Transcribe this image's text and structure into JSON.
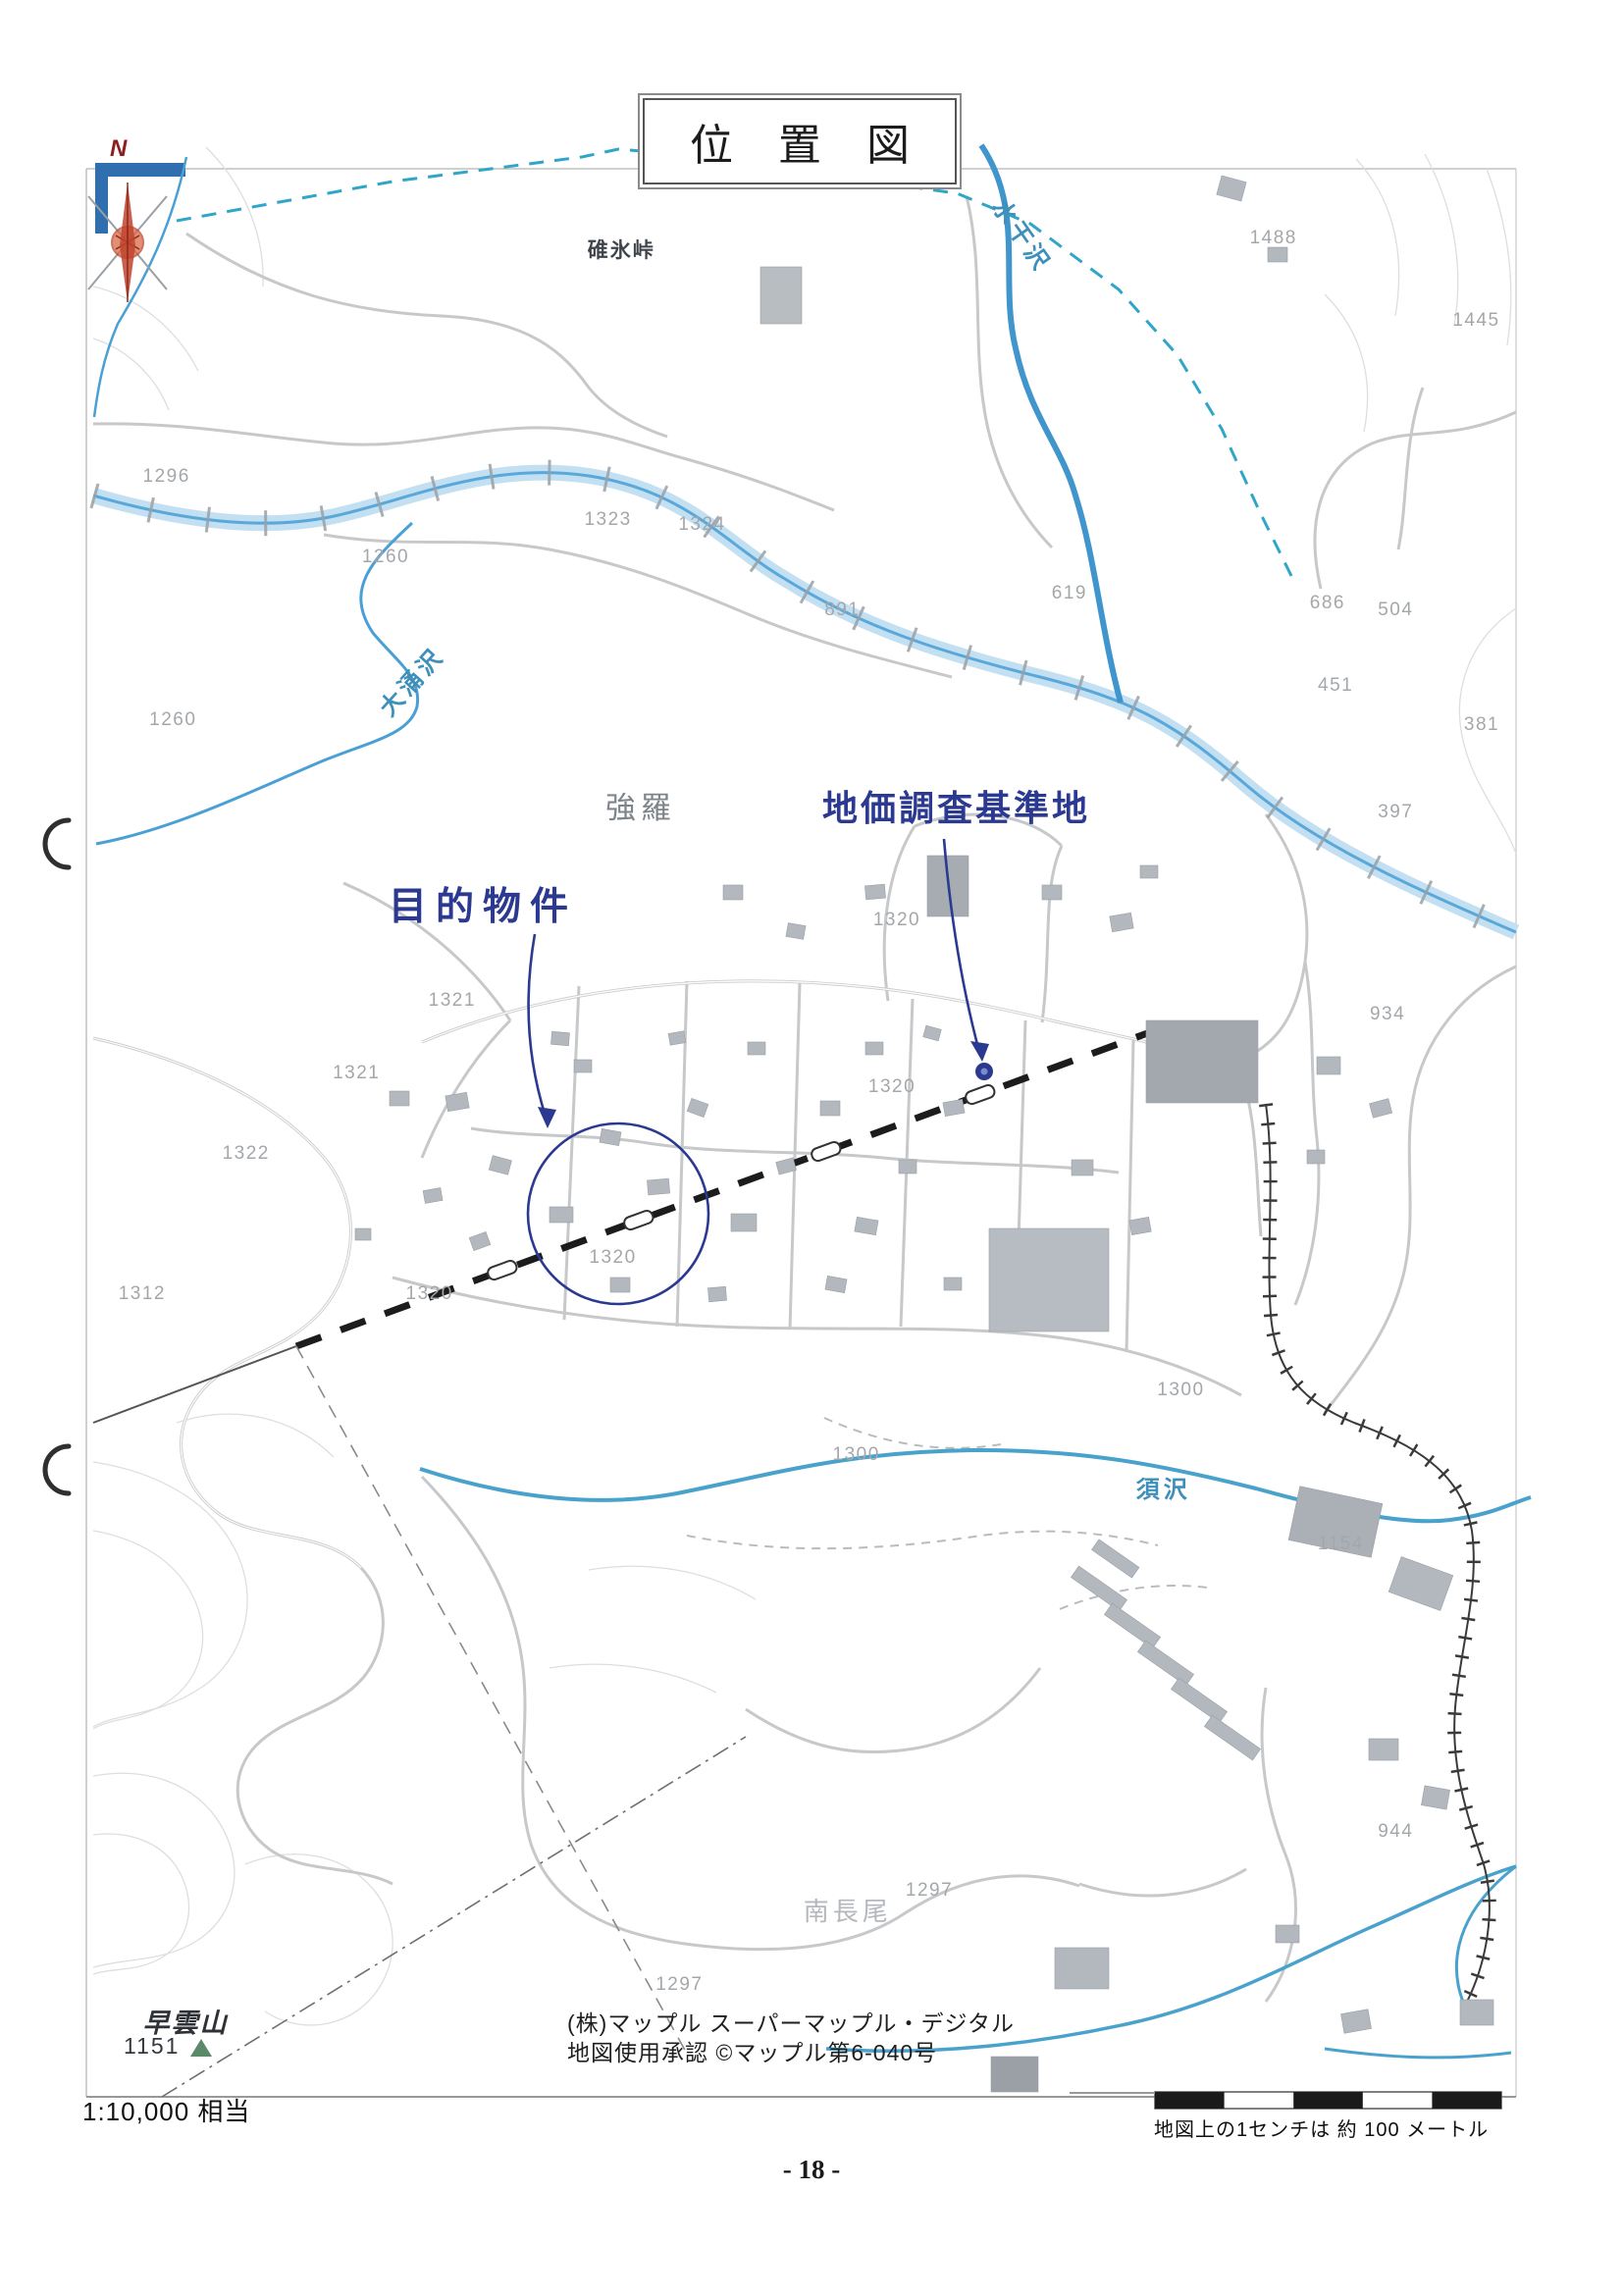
{
  "title": "位置図",
  "compass": {
    "n": "N"
  },
  "annotations": {
    "target_property": "目的物件",
    "survey_point": "地価調査基準地"
  },
  "map": {
    "place_labels": [
      {
        "text": "碓氷峠",
        "x": 36.2,
        "y": 10.2,
        "cls": "lbl-pass"
      },
      {
        "text": "強羅",
        "x": 37.3,
        "y": 34.1,
        "cls": "lbl-town"
      },
      {
        "text": "南長尾",
        "x": 49.5,
        "y": 82.4,
        "cls": "lbl-area"
      },
      {
        "text": "大涌沢",
        "x": 23.6,
        "y": 30.2,
        "cls": "lbl-river",
        "rotate": -48
      },
      {
        "text": "水干沢",
        "x": 61.6,
        "y": 8.0,
        "cls": "lbl-river",
        "rotate": 55
      },
      {
        "text": "須沢",
        "x": 70.0,
        "y": 64.0,
        "cls": "lbl-river"
      },
      {
        "text": "早雲山",
        "x": 8.8,
        "y": 87.2,
        "cls": "lbl-peak"
      }
    ],
    "elevation_labels": [
      {
        "text": "1488",
        "x": 77.0,
        "y": 9.9
      },
      {
        "text": "1445",
        "x": 89.5,
        "y": 13.5
      },
      {
        "text": "1296",
        "x": 8.8,
        "y": 20.3
      },
      {
        "text": "1323",
        "x": 36.0,
        "y": 22.2
      },
      {
        "text": "1324",
        "x": 41.8,
        "y": 22.4
      },
      {
        "text": "1260",
        "x": 22.3,
        "y": 23.8
      },
      {
        "text": "891",
        "x": 50.8,
        "y": 26.1
      },
      {
        "text": "619",
        "x": 64.8,
        "y": 25.4
      },
      {
        "text": "686",
        "x": 80.7,
        "y": 25.8
      },
      {
        "text": "504",
        "x": 84.9,
        "y": 26.1
      },
      {
        "text": "451",
        "x": 81.2,
        "y": 29.4
      },
      {
        "text": "381",
        "x": 90.2,
        "y": 31.1
      },
      {
        "text": "1260",
        "x": 9.2,
        "y": 30.9
      },
      {
        "text": "397",
        "x": 84.9,
        "y": 34.9
      },
      {
        "text": "934",
        "x": 84.4,
        "y": 43.7
      },
      {
        "text": "1320",
        "x": 53.8,
        "y": 39.6
      },
      {
        "text": "1321",
        "x": 26.4,
        "y": 43.1
      },
      {
        "text": "1321",
        "x": 20.5,
        "y": 46.3
      },
      {
        "text": "1322",
        "x": 13.7,
        "y": 49.8
      },
      {
        "text": "1320",
        "x": 53.5,
        "y": 46.9
      },
      {
        "text": "1312",
        "x": 7.3,
        "y": 55.9
      },
      {
        "text": "1320",
        "x": 36.3,
        "y": 54.3
      },
      {
        "text": "1320",
        "x": 25.0,
        "y": 55.9
      },
      {
        "text": "1300",
        "x": 71.3,
        "y": 60.1
      },
      {
        "text": "1300",
        "x": 51.3,
        "y": 62.9
      },
      {
        "text": "1154",
        "x": 81.2,
        "y": 66.8
      },
      {
        "text": "944",
        "x": 84.9,
        "y": 79.3
      },
      {
        "text": "1297",
        "x": 55.8,
        "y": 81.9
      },
      {
        "text": "1297",
        "x": 40.4,
        "y": 86.0
      }
    ],
    "peak_elevation": "1151",
    "credit_line1": "(株)マップル スーパーマップル・デジタル",
    "credit_line2": "地図使用承認  ©マップル第6-040号",
    "scale_ratio": "1:10,000 相当",
    "scale_note": "地図上の1センチは 約 100 メートル"
  },
  "page": {
    "number": "- 18 -"
  },
  "colors": {
    "annotation_navy": "#2b3990",
    "river_blue": "#4aa0d4",
    "boundary_teal": "#2fa6c8",
    "compass_red": "#c0432e"
  }
}
